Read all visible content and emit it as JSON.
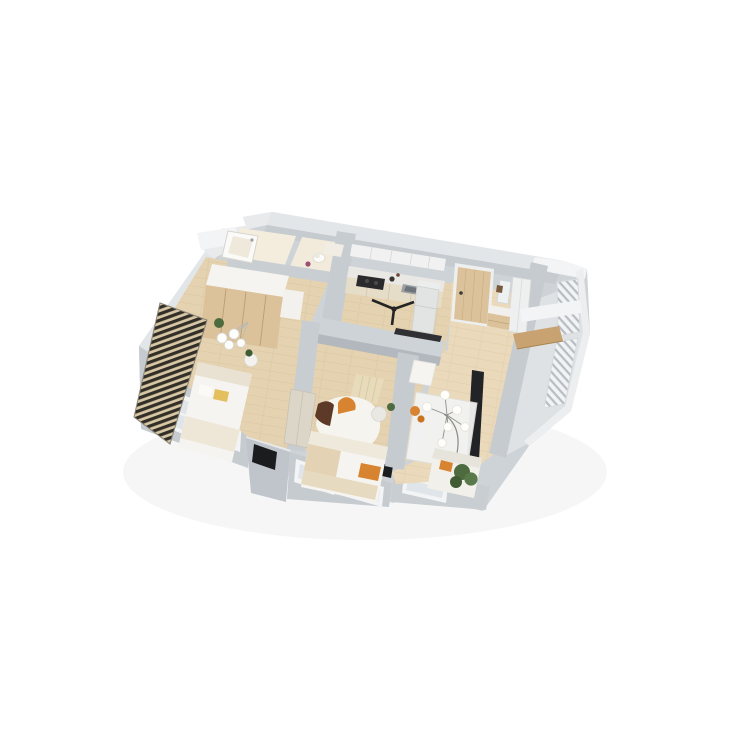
{
  "scene": {
    "type": "isometric-3d-floorplan-render",
    "description": "Aerial 3D cutaway render of a two-bedroom apartment on a plain white background: two bathrooms at the top, an open kitchen with dark cooktop and fridge, an entry hall with a wood front door, a living-dining room with chandelier, sofa and plant, two bedrooms with white beds and orange accent pillows, a dark louvered balcony screen on the left and a white slat-railing balcony on the right.",
    "background": "#ffffff"
  },
  "palette": {
    "background": "#ffffff",
    "shell_top": "#ced3d7",
    "wall_top": "#e3e6e9",
    "wall_face": "#c6cbd0",
    "wall_face_dark": "#b2b8bd",
    "wall_white": "#f3f4f6",
    "floor_wood": "#e4d2b0",
    "floor_wood_light": "#ecdcbd",
    "floor_cream": "#f4eddd",
    "balcony_floor": "#dfe2e4",
    "furniture_white": "#f5f4f0",
    "furniture_cream": "#e9e2d2",
    "wood_light": "#dcc29b",
    "wood_mid": "#c8a371",
    "counter_dark": "#2a2a2c",
    "glass": "#dfe5e9",
    "slat_dark": "#322e28",
    "accent_orange": "#d8832f",
    "accent_yellow": "#e4bf5e",
    "accent_brown": "#5d3a27",
    "accent_purple": "#9c4f74",
    "plant_green": "#4d6b3f",
    "plant_green_dark": "#3f5c34",
    "tv_dark": "#222326"
  },
  "rooms": [
    {
      "id": "bathroom",
      "name": "Bathroom",
      "furniture": [
        "bathtub"
      ]
    },
    {
      "id": "wc",
      "name": "WC",
      "furniture": [
        "toilet",
        "vanity",
        "purple decor"
      ]
    },
    {
      "id": "bedroom-1",
      "name": "Bedroom 1",
      "furniture": [
        "wardrobe",
        "double bed",
        "yellow pillow",
        "pendant globe lights",
        "side table",
        "plant",
        "louvered balcony screen"
      ]
    },
    {
      "id": "kitchen",
      "name": "Kitchen",
      "furniture": [
        "upper cabinets",
        "counter",
        "cooktop",
        "sink",
        "refrigerator",
        "ceiling fan",
        "dark bench"
      ]
    },
    {
      "id": "entry-hall",
      "name": "Entry hall",
      "furniture": [
        "entrance door",
        "mirror",
        "closet",
        "dresser"
      ]
    },
    {
      "id": "living-dining",
      "name": "Living-dining room",
      "furniture": [
        "dining table",
        "chandelier",
        "lounge chair",
        "sofa",
        "orange throw",
        "arc lamp",
        "tv panel",
        "plant"
      ]
    },
    {
      "id": "bedroom-2",
      "name": "Bedroom 2",
      "furniture": [
        "bed",
        "orange pillow",
        "area rug",
        "pouf",
        "wardrobe",
        "curtains",
        "plant"
      ]
    },
    {
      "id": "balcony",
      "name": "Balcony",
      "furniture": [
        "slatted railing",
        "wood console"
      ]
    }
  ]
}
